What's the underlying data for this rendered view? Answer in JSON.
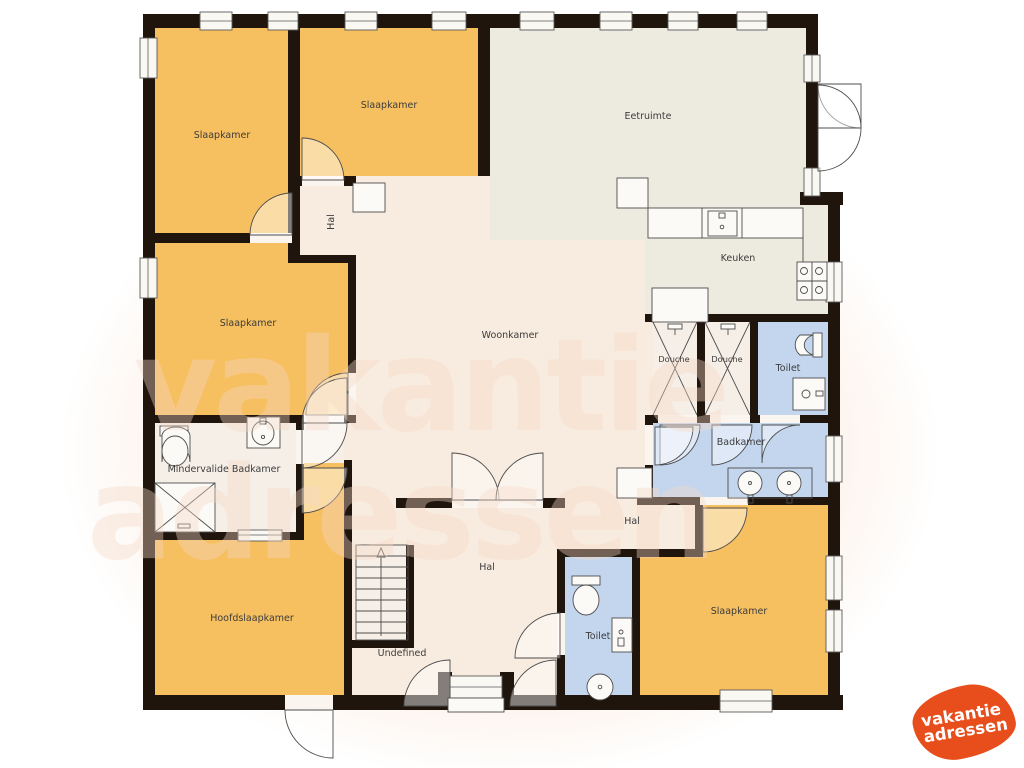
{
  "rooms": {
    "slaapkamer_top_left": "Slaapkamer",
    "slaapkamer_top_mid": "Slaapkamer",
    "eetruimte": "Eetruimte",
    "keuken": "Keuken",
    "hal_top": "Hal",
    "slaapkamer_mid_left": "Slaapkamer",
    "woonkamer": "Woonkamer",
    "douche_1": "Douche",
    "douche_2": "Douche",
    "toilet_top": "Toilet",
    "badkamer": "Badkamer",
    "mindervalide_badkamer": "Mindervalide Badkamer",
    "hal_right": "Hal",
    "hal_bottom": "Hal",
    "hoofdslaapkamer": "Hoofdslaapkamer",
    "undefined_room": "Undefined",
    "toilet_bottom": "Toilet",
    "slaapkamer_bottom_right": "Slaapkamer"
  },
  "watermark": {
    "line1": "vakantie",
    "line2": "adressen"
  },
  "logo": {
    "line1": "vakantie",
    "line2": "adressen"
  },
  "colors": {
    "bedroom": "#F6BF60",
    "dining": "#EDEADF",
    "floor": "#F8EBDF",
    "bath": "#C3D6EE",
    "light": "#F6EFE7",
    "wall": "#20150D",
    "watermark": "#F6D9C6",
    "logo": "#E84E1B"
  }
}
